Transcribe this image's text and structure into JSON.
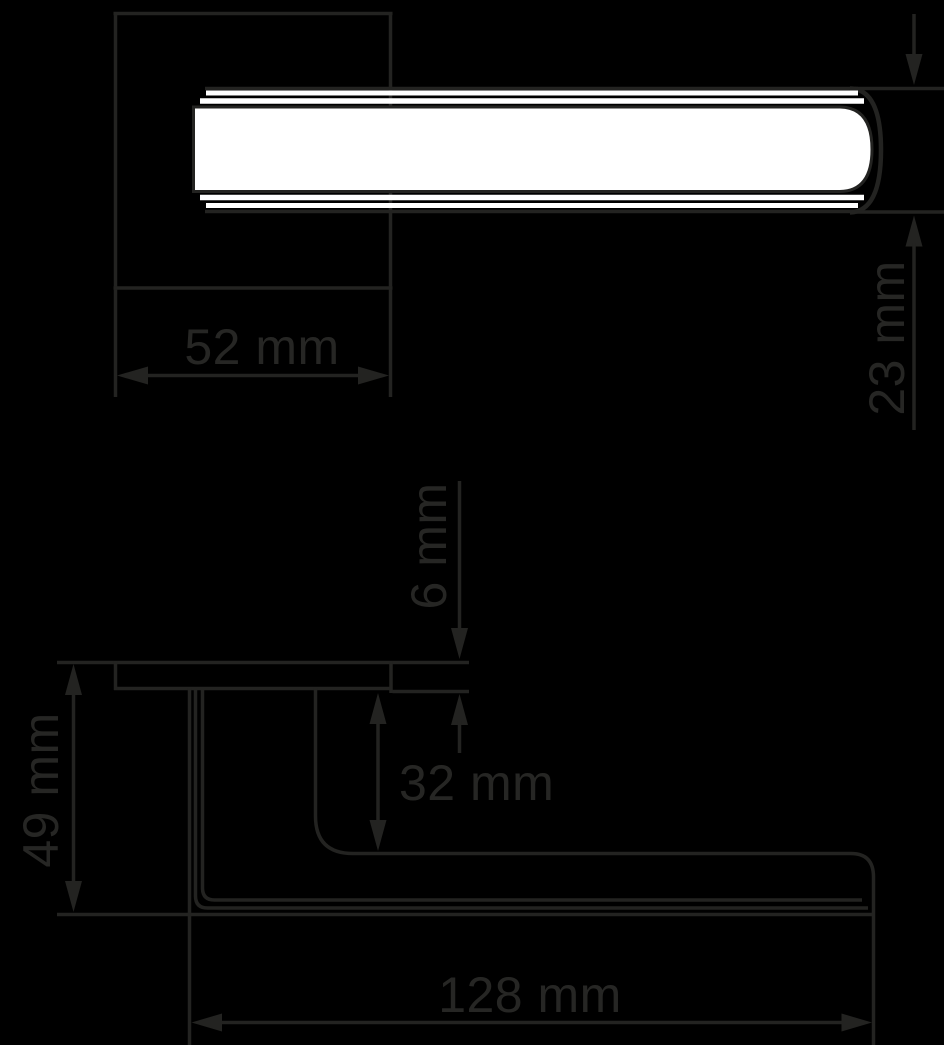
{
  "colors": {
    "background": "#000000",
    "line": "#232321",
    "text": "#262624",
    "handle_fill": "#ffffff"
  },
  "dimensions": {
    "rosette_width": {
      "label": "52 mm",
      "value": 52,
      "unit": "mm"
    },
    "lever_thickness": {
      "label": "23 mm",
      "value": 23,
      "unit": "mm"
    },
    "rosette_depth": {
      "label": "6 mm",
      "value": 6,
      "unit": "mm"
    },
    "neck_height": {
      "label": "32 mm",
      "value": 32,
      "unit": "mm"
    },
    "total_projection": {
      "label": "49 mm",
      "value": 49,
      "unit": "mm"
    },
    "lever_length": {
      "label": "128 mm",
      "value": 128,
      "unit": "mm"
    }
  }
}
